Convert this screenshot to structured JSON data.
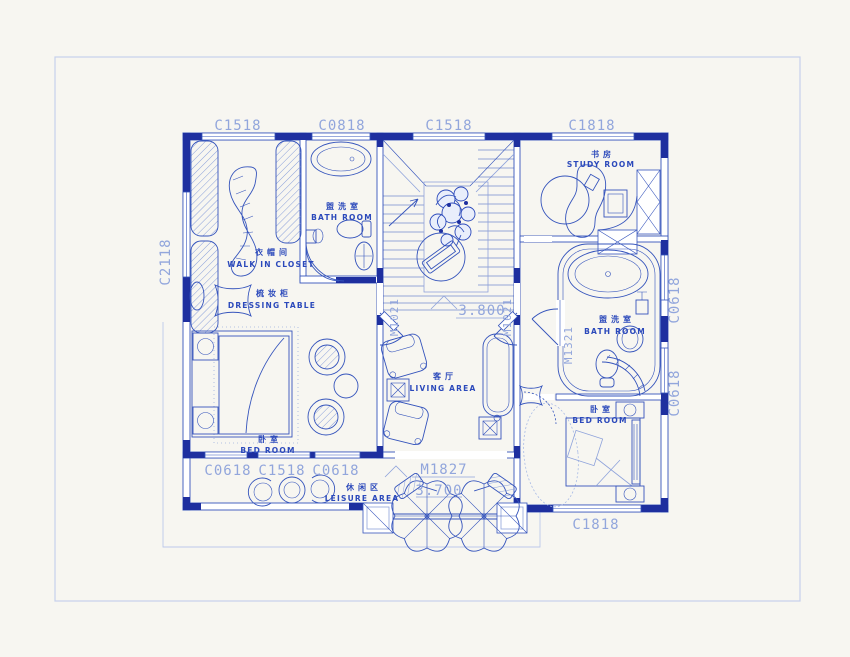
{
  "page": {
    "background": "#f7f6f1",
    "frame_color": "#c6d0ec"
  },
  "plan": {
    "colors": {
      "line": "#3554bc",
      "dark_fill": "#1e2f9f",
      "light_text": "#92a6dc",
      "faint": "#bcc8ea",
      "room_text": "#2b49bb"
    },
    "rooms": {
      "walk_in_closet": {
        "zh": "衣帽间",
        "en": "WALK IN CLOSET"
      },
      "dressing_table": {
        "zh": "梳妆柜",
        "en": "DRESSING TABLE"
      },
      "bath_top": {
        "zh": "盥洗室",
        "en": "BATH ROOM"
      },
      "study": {
        "zh": "书房",
        "en": "STUDY ROOM"
      },
      "living": {
        "zh": "客厅",
        "en": "LIVING AREA"
      },
      "bed_left": {
        "zh": "卧室",
        "en": "BED ROOM"
      },
      "bath_right": {
        "zh": "盥洗室",
        "en": "BATH ROOM"
      },
      "bed_right": {
        "zh": "卧室",
        "en": "BED ROOM"
      },
      "leisure": {
        "zh": "休闲区",
        "en": "LEISURE AREA"
      }
    },
    "windows": {
      "top": [
        "C1518",
        "C0818",
        "C1518",
        "C1818"
      ],
      "left": "C2118",
      "bottom_left": [
        "C0618",
        "C1518",
        "C0618"
      ],
      "right": [
        "C0618",
        "C0618"
      ],
      "bottom_right": "C1818"
    },
    "doors": {
      "stair_left": "M1021",
      "stair_right": "M1021",
      "bath_right": "M1321",
      "entry": "M1827"
    },
    "levels": {
      "living": "3.800",
      "leisure": "3.700"
    }
  }
}
